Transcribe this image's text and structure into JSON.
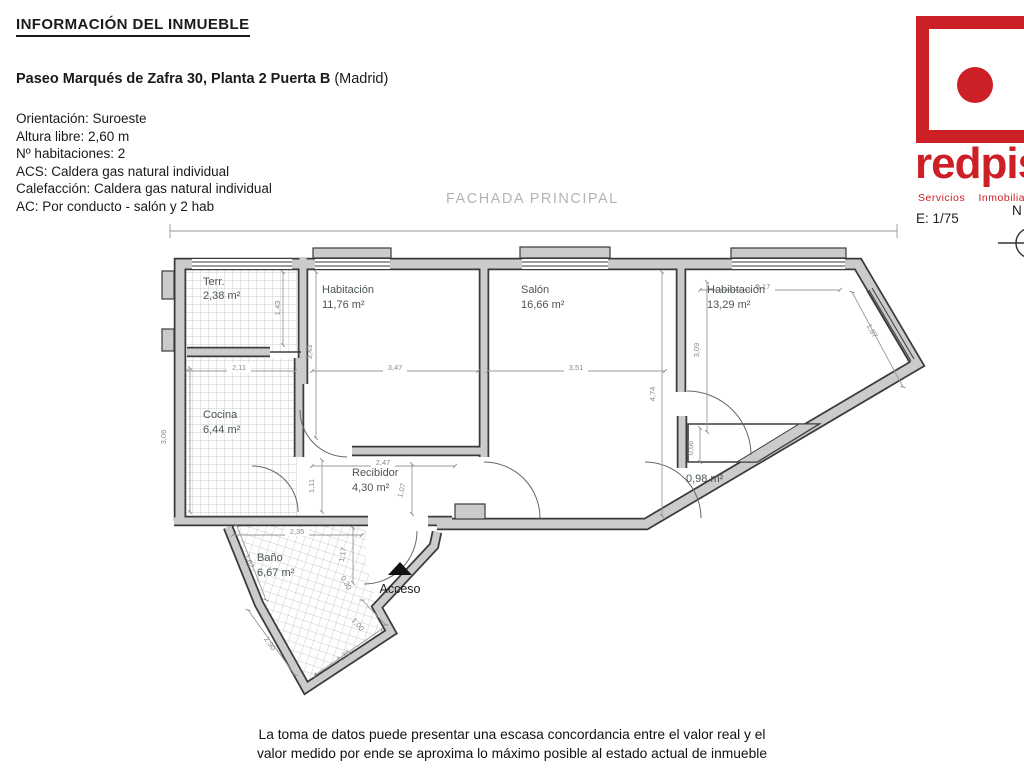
{
  "header": {
    "title": "INFORMACIÓN DEL INMUEBLE",
    "address_bold": "Paseo Marqués de Zafra 30, Planta 2 Puerta B",
    "address_light": " (Madrid)"
  },
  "details": {
    "line1": "Orientación: Suroeste",
    "line2": "Altura libre: 2,60 m",
    "line3": "Nº habitaciones: 2",
    "line4": "ACS: Caldera gas natural individual",
    "line5": "Calefacción: Caldera gas natural individual",
    "line6": "AC: Por conducto - salón y 2 hab"
  },
  "logo": {
    "brand": "redpiso",
    "tagline": "Servicios  Inmobiliarios"
  },
  "plan": {
    "facade_label": "FACHADA PRINCIPAL",
    "scale_label": "E: 1/75",
    "north_label": "N",
    "access_label": "Acceso",
    "rooms": {
      "terraza": {
        "name": "Terr.",
        "area": "2,38 m²"
      },
      "hab1": {
        "name": "Habitación",
        "area": "11,76 m²"
      },
      "salon": {
        "name": "Salón",
        "area": "16,66 m²"
      },
      "hab2": {
        "name": "Habibtación",
        "area": "13,29 m²"
      },
      "cocina": {
        "name": "Cocina",
        "area": "6,44 m²"
      },
      "recibidor": {
        "name": "Recibidor",
        "area": "4,30 m²"
      },
      "armario": {
        "area": "0,98 m²"
      },
      "bano": {
        "name": "Baño",
        "area": "6,67 m²"
      }
    },
    "dims": {
      "terraza_w": "2,11",
      "hab1_w": "3,47",
      "salon_w": "3,51",
      "hab2_w": "3,17",
      "terraza_h": "1,43",
      "hab1_h": "3,43",
      "cocina_h": "3,06",
      "salon_h": "4,74",
      "hab2_h": "3,09",
      "hab2_diag": "1,87",
      "armario_h": "0,66",
      "pasillo_w": "1,11",
      "recibidor_w": "2,47",
      "salon_door": "1,07",
      "bano_w": "2,35",
      "bano_door": "1,17",
      "bano_left": "1,62",
      "bano_notch": "0,30",
      "bano_right": "1,00",
      "bano_diag_left": "2,90",
      "bano_diag_right": "1,70"
    }
  },
  "footer": {
    "line1": "La toma de datos puede presentar una escasa concordancia entre el valor real y el",
    "line2": "valor medido por ende se aproxima lo máximo posible al estado actual de inmueble"
  },
  "colors": {
    "brand_red": "#cc2026",
    "room_label_green": "#4a564e",
    "wall_fill": "#cbcbcb",
    "wall_edge": "#3b3b3b",
    "facade_gray": "#b4b4b4"
  }
}
